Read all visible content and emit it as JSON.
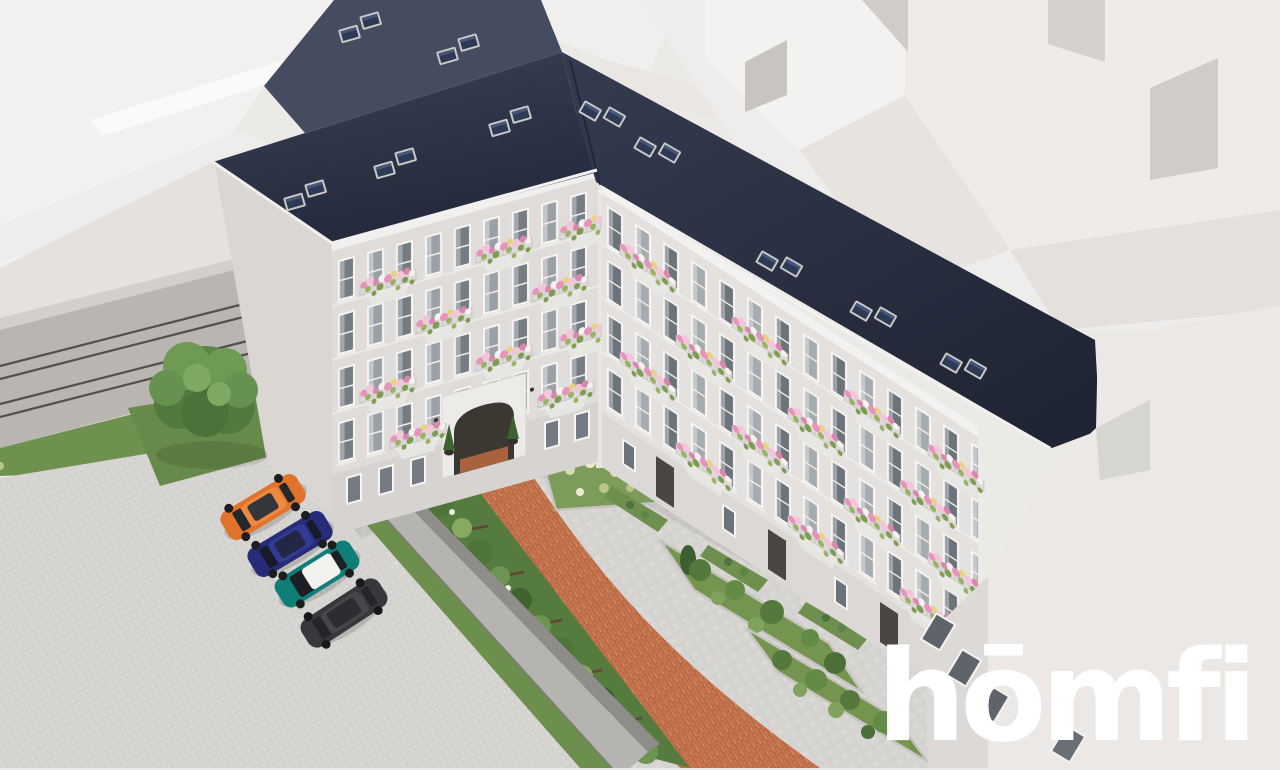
{
  "watermark": {
    "logo_text": "hōmfi",
    "color": "#ffffff"
  },
  "scene": {
    "description": "aerial 3d rendering of renovated tenement building with courtyard",
    "palette": {
      "roof_dark": "#272e41",
      "roof_back_slope": "#454c60",
      "facade": "#e2dfdc",
      "trim_white": "#f4f2f0",
      "background_buildings": "#efedea",
      "courtyard_paving": "#d7d5d2",
      "parking_paving": "#d9d7d3",
      "brick_path": "#c6764e",
      "grass": "#6e9150",
      "boundary_wall": "#b6b4b1",
      "flowers_pink": "#e793bb",
      "flowers_light_pink": "#f2c6d8",
      "flowers_yellow": "#e8d27c"
    },
    "cars": [
      {
        "label": "orange SUV",
        "color": "#e2732d"
      },
      {
        "label": "navy blue SUV",
        "color": "#262c78"
      },
      {
        "label": "teal car with white roof",
        "color": "#0f7e77"
      },
      {
        "label": "dark gray sedan",
        "color": "#36383c"
      }
    ]
  }
}
